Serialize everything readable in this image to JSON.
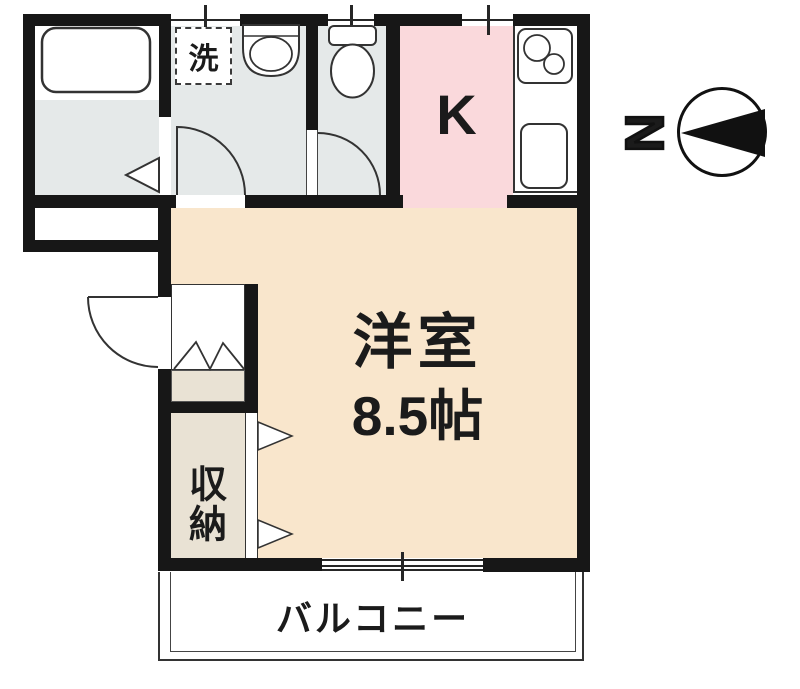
{
  "compass": {
    "label": "N"
  },
  "rooms": {
    "kitchen": {
      "label": "K"
    },
    "western_room": {
      "name": "洋室",
      "size": "8.5帖"
    },
    "storage": {
      "label": "収納"
    },
    "balcony": {
      "label": "バルコニー"
    },
    "laundry": {
      "label": "洗"
    }
  },
  "colors": {
    "wall": "#171717",
    "wet_area": "#E5E9E9",
    "kitchen": "#FAD9DC",
    "room": "#F9E6CC",
    "storage": "#E9E2D4"
  }
}
